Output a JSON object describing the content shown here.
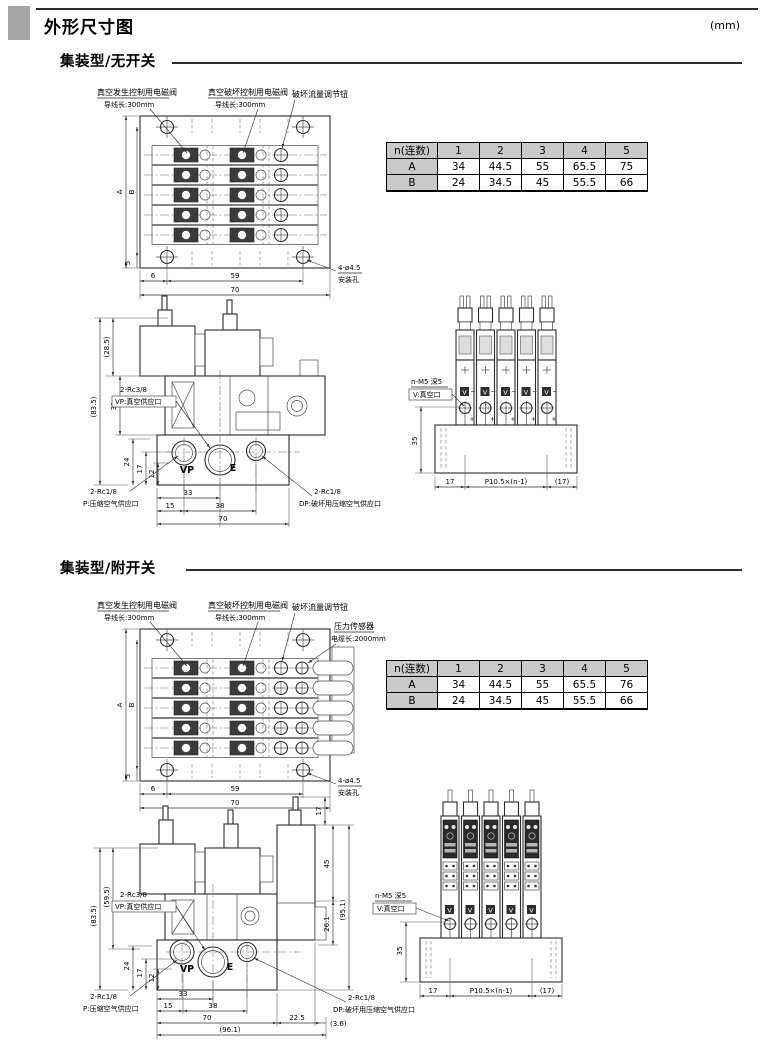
{
  "header": {
    "title": "外形尺寸图",
    "unit_note": "(mm)"
  },
  "section1": {
    "heading": "集装型/无开关",
    "table": {
      "col0": "n(连数)",
      "cols": [
        "1",
        "2",
        "3",
        "4",
        "5"
      ],
      "rowA": {
        "label": "A",
        "values": [
          "34",
          "44.5",
          "55",
          "65.5",
          "75"
        ]
      },
      "rowB": {
        "label": "B",
        "values": [
          "24",
          "34.5",
          "45",
          "55.5",
          "66"
        ]
      }
    },
    "front_dims": {
      "t285": "(28.5)",
      "t835": "(83.5)",
      "t31": "31",
      "v24": "24",
      "v17": "17",
      "v12": "12",
      "w33": "33",
      "w15": "15",
      "w38": "38",
      "w70": "70"
    }
  },
  "section2": {
    "heading": "集装型/附开关",
    "table": {
      "col0": "n(连数)",
      "cols": [
        "1",
        "2",
        "3",
        "4",
        "5"
      ],
      "rowA": {
        "label": "A",
        "values": [
          "34",
          "44.5",
          "55",
          "65.5",
          "76"
        ]
      },
      "rowB": {
        "label": "B",
        "values": [
          "24",
          "34.5",
          "45",
          "55.5",
          "66"
        ]
      }
    },
    "front_dims": {
      "t595": "(59.5)",
      "t835": "(83.5)",
      "v24": "24",
      "v17": "17",
      "v12": "12",
      "w33": "33",
      "w15": "15",
      "w38": "38",
      "w70": "70",
      "w225": "22.5",
      "w36": "(3.6)",
      "w961": "(96.1)",
      "s17": "17",
      "s45": "45",
      "s261": "26.1",
      "s951": "(95.1)"
    }
  },
  "shared": {
    "topview": {
      "A": "A",
      "B": "B",
      "m5": "5",
      "m6": "6",
      "m59": "59",
      "m70": "70",
      "hole1": "4-ø4.5",
      "hole2": "安装孔",
      "sol1a": "真空发生控制用电磁阀",
      "sol1b": "导线长:300mm",
      "sol2a": "真空破坏控制用电磁阀",
      "sol2b": "导线长:300mm",
      "knob": "破坏流量调节钮",
      "sensor1": "压力传感器",
      "sensor2": "电缆长:2000mm"
    },
    "frontview": {
      "rc38": "2-Rc3/8",
      "vp_port": "VP:真空供应口",
      "rc18": "2-Rc1/8",
      "p_port": "P:压缩空气供应口",
      "dp_port": "DP:破坏用压缩空气供应口",
      "vp": "VP",
      "e": "E"
    },
    "sideview": {
      "v35": "35",
      "w17": "17",
      "pitch": "P10.5×(n-1)",
      "w17p": "(17)",
      "m5a": "n-M5 深5",
      "m5b": "V:真空口",
      "v": "V"
    }
  }
}
